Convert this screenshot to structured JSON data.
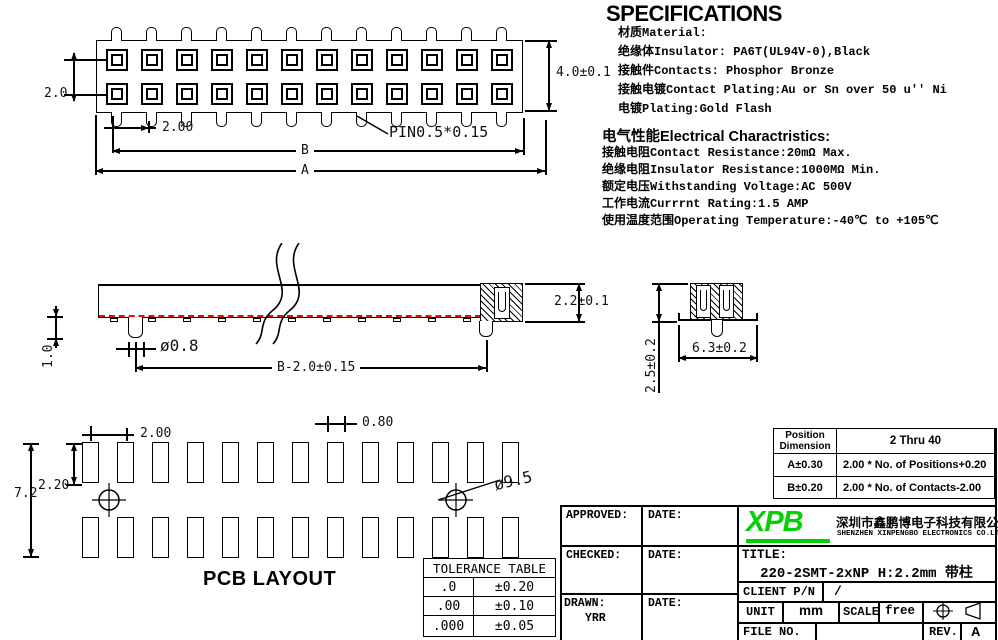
{
  "specs": {
    "heading": "SPECIFICATIONS",
    "material_lines": [
      "材质Material:",
      "绝缘体Insulator: PA6T(UL94V-0),Black",
      "接触件Contacts: Phosphor Bronze",
      "接触电镀Contact Plating:Au or Sn over 50 u'' Ni",
      "电镀Plating:Gold Flash"
    ],
    "electrical_heading": "电气性能Electrical Charactristics:",
    "electrical_lines": [
      "接触电阻Contact Resistance:20mΩ Max.",
      "绝缘电阻Insulator Resistance:1000MΩ Min.",
      "额定电压Withstanding Voltage:AC 500V",
      "工作电流Currrnt Rating:1.5 AMP",
      "使用温度范围Operating Temperature:-40℃ to +105℃"
    ]
  },
  "top_view": {
    "columns": 12,
    "rows": 2,
    "dims": {
      "row_pitch": "2.0",
      "body_height": "4.0±0.1",
      "pitch": "2.00",
      "pin_note": "PIN0.5*0.15",
      "span_b": "B",
      "span_a": "A"
    }
  },
  "side_view": {
    "feet": 11,
    "dims": {
      "height": "2.2±0.1",
      "peg_length": "1.0",
      "peg_dia": "ø0.8",
      "span": "B-2.0±0.15"
    }
  },
  "end_view": {
    "dims": {
      "width": "6.3±0.2",
      "height": "2.5±0.2"
    }
  },
  "pcb": {
    "label": "PCB LAYOUT",
    "columns": 13,
    "dims": {
      "pitch": "2.00",
      "pad_width": "0.80",
      "pad_height": "2.20",
      "row_span": "7.2",
      "hole_dia": "ø9.5"
    }
  },
  "position_table": {
    "header_line1": "Position",
    "header_line2": "Dimension",
    "header_range": "2 Thru 40",
    "rows": [
      [
        "A±0.30",
        "2.00 * No. of Positions+0.20"
      ],
      [
        "B±0.20",
        "2.00 * No. of Contacts-2.00"
      ]
    ]
  },
  "tolerance_table": {
    "title": "TOLERANCE TABLE",
    "rows": [
      [
        ".0",
        "±0.20"
      ],
      [
        ".00",
        "±0.10"
      ],
      [
        ".000",
        "±0.05"
      ]
    ]
  },
  "title_block": {
    "approved_label": "APPROVED:",
    "checked_label": "CHECKED:",
    "drawn_label": "DRAWN:",
    "drawn_by": "YRR",
    "date_label": "DATE:",
    "logo_text": "XPB",
    "logo_color": "#00d200",
    "company_cn": "深圳市鑫鹏博电子科技有限公司",
    "company_en": "SHENZHEN XINPENGBO ELECTRONICS CO.LTD",
    "title_label": "TITLE:",
    "title_value": "220-2SMT-2xNP H:2.2mm 带柱",
    "client_label": "CLIENT P/N",
    "client_value": "/",
    "unit_label": "UNIT",
    "unit_value": "mm",
    "scale_label": "SCALE",
    "scale_value": "free",
    "file_label": "FILE NO.",
    "rev_label": "REV.",
    "rev_value": "A"
  }
}
